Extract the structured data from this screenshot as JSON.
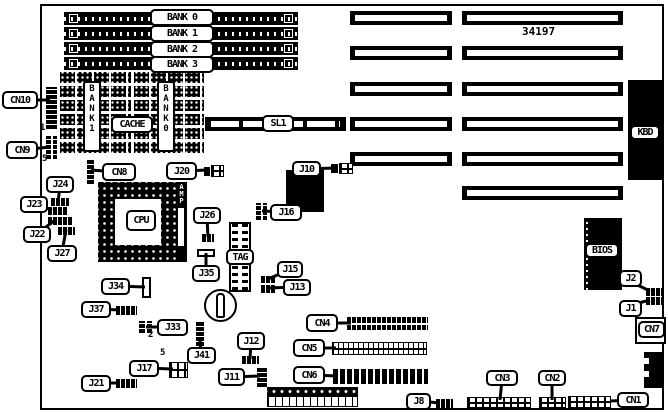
{
  "figure": {
    "part_number": "34197",
    "subject": "motherboard-layout-diagram"
  },
  "board": {
    "x": 40,
    "y": 4,
    "w": 624,
    "h": 406
  },
  "labels": [
    {
      "name": "label-cn10",
      "text": "CN10",
      "x": 2,
      "y": 91,
      "w": 36,
      "h": 18
    },
    {
      "name": "label-cn9",
      "text": "CN9",
      "x": 6,
      "y": 141,
      "w": 32,
      "h": 18
    },
    {
      "name": "label-j24",
      "text": "J24",
      "x": 46,
      "y": 176,
      "w": 28,
      "h": 17
    },
    {
      "name": "label-j23",
      "text": "J23",
      "x": 20,
      "y": 196,
      "w": 28,
      "h": 17
    },
    {
      "name": "label-j22",
      "text": "J22",
      "x": 23,
      "y": 226,
      "w": 28,
      "h": 17
    },
    {
      "name": "label-j27",
      "text": "J27",
      "x": 47,
      "y": 245,
      "w": 30,
      "h": 17
    },
    {
      "name": "label-cn8",
      "text": "CN8",
      "x": 102,
      "y": 163,
      "w": 34,
      "h": 18
    },
    {
      "name": "label-j20",
      "text": "J20",
      "x": 166,
      "y": 162,
      "w": 31,
      "h": 18
    },
    {
      "name": "label-j26",
      "text": "J26",
      "x": 193,
      "y": 207,
      "w": 28,
      "h": 17
    },
    {
      "name": "label-j35",
      "text": "J35",
      "x": 192,
      "y": 265,
      "w": 28,
      "h": 17
    },
    {
      "name": "label-j34",
      "text": "J34",
      "x": 101,
      "y": 278,
      "w": 29,
      "h": 17
    },
    {
      "name": "label-j37",
      "text": "J37",
      "x": 81,
      "y": 301,
      "w": 30,
      "h": 17
    },
    {
      "name": "label-j33",
      "text": "J33",
      "x": 157,
      "y": 319,
      "w": 31,
      "h": 17
    },
    {
      "name": "label-j41",
      "text": "J41",
      "x": 187,
      "y": 347,
      "w": 29,
      "h": 17
    },
    {
      "name": "label-j17",
      "text": "J17",
      "x": 129,
      "y": 360,
      "w": 30,
      "h": 17
    },
    {
      "name": "label-j21",
      "text": "J21",
      "x": 81,
      "y": 375,
      "w": 30,
      "h": 17
    },
    {
      "name": "label-j12",
      "text": "J12",
      "x": 237,
      "y": 332,
      "w": 28,
      "h": 18
    },
    {
      "name": "label-j11",
      "text": "J11",
      "x": 218,
      "y": 368,
      "w": 27,
      "h": 18
    },
    {
      "name": "label-j15",
      "text": "J15",
      "x": 277,
      "y": 261,
      "w": 26,
      "h": 17
    },
    {
      "name": "label-j13",
      "text": "J13",
      "x": 283,
      "y": 279,
      "w": 28,
      "h": 17
    },
    {
      "name": "label-j10",
      "text": "J10",
      "x": 292,
      "y": 161,
      "w": 29,
      "h": 16
    },
    {
      "name": "label-j16",
      "text": "J16",
      "x": 270,
      "y": 204,
      "w": 32,
      "h": 17
    },
    {
      "name": "label-cn4",
      "text": "CN4",
      "x": 306,
      "y": 314,
      "w": 32,
      "h": 18
    },
    {
      "name": "label-cn5",
      "text": "CN5",
      "x": 293,
      "y": 339,
      "w": 32,
      "h": 18
    },
    {
      "name": "label-cn6",
      "text": "CN6",
      "x": 293,
      "y": 366,
      "w": 32,
      "h": 18
    },
    {
      "name": "label-j8",
      "text": "J8",
      "x": 406,
      "y": 393,
      "w": 25,
      "h": 17
    },
    {
      "name": "label-cn3",
      "text": "CN3",
      "x": 486,
      "y": 370,
      "w": 32,
      "h": 16
    },
    {
      "name": "label-cn2",
      "text": "CN2",
      "x": 538,
      "y": 370,
      "w": 28,
      "h": 16
    },
    {
      "name": "label-cn1",
      "text": "CN1",
      "x": 617,
      "y": 392,
      "w": 32,
      "h": 16
    },
    {
      "name": "label-j2",
      "text": "J2",
      "x": 619,
      "y": 270,
      "w": 23,
      "h": 17
    },
    {
      "name": "label-j1",
      "text": "J1",
      "x": 619,
      "y": 300,
      "w": 23,
      "h": 17
    },
    {
      "name": "label-cn7",
      "text": "CN7",
      "x": 638,
      "y": 321,
      "w": 27,
      "h": 17
    }
  ],
  "chip_labels": [
    {
      "name": "label-bank0",
      "text": "BANK 0",
      "x": 150,
      "y": 9,
      "w": 64,
      "h": 17
    },
    {
      "name": "label-bank1",
      "text": "BANK 1",
      "x": 150,
      "y": 25,
      "w": 64,
      "h": 17
    },
    {
      "name": "label-bank2",
      "text": "BANK 2",
      "x": 150,
      "y": 41,
      "w": 64,
      "h": 17
    },
    {
      "name": "label-bank3",
      "text": "BANK 3",
      "x": 150,
      "y": 56,
      "w": 64,
      "h": 17
    },
    {
      "name": "label-sl1",
      "text": "SL1",
      "x": 262,
      "y": 115,
      "w": 32,
      "h": 17
    },
    {
      "name": "label-cache",
      "text": "CACHE",
      "x": 111,
      "y": 116,
      "w": 42,
      "h": 17
    },
    {
      "name": "label-cpu",
      "text": "CPU",
      "x": 126,
      "y": 210,
      "w": 30,
      "h": 21
    },
    {
      "name": "label-tag",
      "text": "TAG",
      "x": 226,
      "y": 249,
      "w": 28,
      "h": 16
    },
    {
      "name": "label-bios",
      "text": "BIOS",
      "x": 585,
      "y": 243,
      "w": 34,
      "h": 15
    },
    {
      "name": "label-kbd",
      "text": "KBD",
      "x": 630,
      "y": 125,
      "w": 30,
      "h": 15
    }
  ],
  "vertical_labels": [
    {
      "name": "label-sram-bank1",
      "text": "B\nA\nN\nK\n1",
      "x": 83,
      "y": 81,
      "w": 18,
      "h": 71
    },
    {
      "name": "label-sram-bank0",
      "text": "B\nA\nN\nK\n0",
      "x": 157,
      "y": 81,
      "w": 18,
      "h": 71
    }
  ],
  "texts": [
    {
      "name": "part-number",
      "text": "34197",
      "x": 522,
      "y": 25,
      "size": 11
    },
    {
      "name": "pin1-marker-cn10",
      "text": "1",
      "x": 40,
      "y": 123,
      "size": 9
    },
    {
      "name": "pin5-marker-cn9",
      "text": "5",
      "x": 42,
      "y": 154,
      "size": 9
    },
    {
      "name": "pin2-marker-j33",
      "text": "2",
      "x": 148,
      "y": 330,
      "size": 9
    },
    {
      "name": "pin5-marker-j17",
      "text": "5",
      "x": 160,
      "y": 348,
      "size": 9
    }
  ],
  "chips": [
    {
      "name": "kbd-connector",
      "cls": "chip",
      "x": 628,
      "y": 80,
      "w": 36,
      "h": 100
    },
    {
      "name": "bios-chip",
      "cls": "bios",
      "x": 584,
      "y": 218,
      "w": 38,
      "h": 72
    },
    {
      "name": "controller-chip",
      "cls": "chip",
      "x": 286,
      "y": 170,
      "w": 38,
      "h": 42
    },
    {
      "name": "amp-voltage-regulator",
      "cls": "amp",
      "x": 176,
      "y": 182,
      "w": 11,
      "h": 80,
      "text": "AMP"
    },
    {
      "name": "cpu-socket",
      "cls": "cpusocket",
      "x": 98,
      "y": 182,
      "w": 80,
      "h": 80
    },
    {
      "name": "tag-ram-chip",
      "cls": "tagchip",
      "x": 229,
      "y": 222,
      "w": 22,
      "h": 70
    },
    {
      "name": "cache-sram-array-bank1",
      "cls": "sram",
      "x": 60,
      "y": 70,
      "w": 71,
      "h": 83
    },
    {
      "name": "cache-sram-array-bank0",
      "cls": "sram",
      "x": 134,
      "y": 70,
      "w": 70,
      "h": 83
    },
    {
      "name": "sl1-slot",
      "cls": "sl1",
      "x": 205,
      "y": 117,
      "w": 141,
      "h": 14
    },
    {
      "name": "battery",
      "cls": "battery",
      "x": 204,
      "y": 289,
      "w": 33,
      "h": 33
    },
    {
      "name": "battery-capsule",
      "cls": "capsule",
      "x": 216,
      "y": 293,
      "w": 9,
      "h": 25
    },
    {
      "name": "power-connector-pins",
      "cls": "powertop",
      "x": 267,
      "y": 387,
      "w": 91,
      "h": 9
    },
    {
      "name": "power-connector-body",
      "cls": "powerbot",
      "x": 267,
      "y": 396,
      "w": 91,
      "h": 11
    },
    {
      "name": "edge-connector",
      "cls": "chip",
      "x": 644,
      "y": 352,
      "w": 20,
      "h": 36
    },
    {
      "name": "edge-connector-notch-a",
      "cls": "notch",
      "x": 644,
      "y": 358,
      "w": 5,
      "h": 6
    },
    {
      "name": "edge-connector-notch-b",
      "cls": "notch",
      "x": 644,
      "y": 371,
      "w": 5,
      "h": 6
    },
    {
      "name": "cn7-connector-body",
      "cls": "whitebox",
      "x": 635,
      "y": 317,
      "w": 31,
      "h": 27
    }
  ],
  "headers": [
    {
      "name": "cn10-header",
      "cls": "vstrip",
      "x": 46,
      "y": 87,
      "w": 11,
      "h": 42
    },
    {
      "name": "cn9-header",
      "cls": "grid2",
      "x": 46,
      "y": 136,
      "w": 11,
      "h": 23
    },
    {
      "name": "j24-jumper",
      "cls": "hstrip",
      "x": 51,
      "y": 198,
      "w": 18,
      "h": 8
    },
    {
      "name": "j23-jumper",
      "cls": "hstrip",
      "x": 48,
      "y": 207,
      "w": 20,
      "h": 8
    },
    {
      "name": "j22-jumper",
      "cls": "hstrip",
      "x": 48,
      "y": 217,
      "w": 25,
      "h": 8
    },
    {
      "name": "j27-jumper",
      "cls": "hstrip",
      "x": 58,
      "y": 227,
      "w": 17,
      "h": 8
    },
    {
      "name": "cn8-header",
      "cls": "vstrip",
      "x": 87,
      "y": 160,
      "w": 7,
      "h": 24
    },
    {
      "name": "j20-header-pin",
      "cls": "solidsm",
      "x": 204,
      "y": 167,
      "w": 6,
      "h": 9
    },
    {
      "name": "j20-header",
      "cls": "hbox",
      "x": 211,
      "y": 165,
      "w": 13,
      "h": 12
    },
    {
      "name": "j26-jumper",
      "cls": "hstrip",
      "x": 202,
      "y": 234,
      "w": 12,
      "h": 8
    },
    {
      "name": "j35-component",
      "cls": "whitebox",
      "x": 197,
      "y": 249,
      "w": 18,
      "h": 8
    },
    {
      "name": "j34-component",
      "cls": "whitebox",
      "x": 142,
      "y": 277,
      "w": 9,
      "h": 21
    },
    {
      "name": "j37-jumper",
      "cls": "hstrip",
      "x": 116,
      "y": 306,
      "w": 21,
      "h": 9
    },
    {
      "name": "j33-jumper",
      "cls": "grid2",
      "x": 139,
      "y": 321,
      "w": 13,
      "h": 12
    },
    {
      "name": "j41-header",
      "cls": "vstrip",
      "x": 196,
      "y": 321,
      "w": 8,
      "h": 25
    },
    {
      "name": "j17-header",
      "cls": "hbox",
      "x": 169,
      "y": 362,
      "w": 19,
      "h": 16
    },
    {
      "name": "j21-jumper",
      "cls": "hstrip",
      "x": 116,
      "y": 379,
      "w": 21,
      "h": 9
    },
    {
      "name": "j12-jumper",
      "cls": "hstrip",
      "x": 242,
      "y": 356,
      "w": 17,
      "h": 8
    },
    {
      "name": "j11-header",
      "cls": "vstrip",
      "x": 257,
      "y": 367,
      "w": 10,
      "h": 20
    },
    {
      "name": "j16-header",
      "cls": "grid2",
      "x": 256,
      "y": 203,
      "w": 11,
      "h": 17
    },
    {
      "name": "j15-jumper",
      "cls": "hstrip",
      "x": 261,
      "y": 276,
      "w": 14,
      "h": 7
    },
    {
      "name": "j13-jumper",
      "cls": "hstrip",
      "x": 261,
      "y": 285,
      "w": 14,
      "h": 8
    },
    {
      "name": "j10-header-pin",
      "cls": "solidsm",
      "x": 331,
      "y": 164,
      "w": 7,
      "h": 9
    },
    {
      "name": "j10-header",
      "cls": "hbox",
      "x": 339,
      "y": 163,
      "w": 14,
      "h": 11
    },
    {
      "name": "cn4-header",
      "cls": "cn4",
      "x": 347,
      "y": 317,
      "w": 81,
      "h": 13
    },
    {
      "name": "cn5-header",
      "cls": "hboxdense",
      "x": 332,
      "y": 342,
      "w": 95,
      "h": 13
    },
    {
      "name": "cn6-header",
      "cls": "cn6",
      "x": 333,
      "y": 369,
      "w": 95,
      "h": 15
    },
    {
      "name": "j8-header",
      "cls": "hstrip",
      "x": 436,
      "y": 399,
      "w": 17,
      "h": 9
    },
    {
      "name": "cn3-header",
      "cls": "hbox",
      "x": 467,
      "y": 397,
      "w": 64,
      "h": 11
    },
    {
      "name": "cn2-header",
      "cls": "hbox",
      "x": 539,
      "y": 397,
      "w": 27,
      "h": 11
    },
    {
      "name": "cn1-header",
      "cls": "hbox",
      "x": 568,
      "y": 396,
      "w": 43,
      "h": 12
    },
    {
      "name": "j2-jumper",
      "cls": "hstrip",
      "x": 646,
      "y": 288,
      "w": 17,
      "h": 8
    },
    {
      "name": "j1-jumper",
      "cls": "hstrip",
      "x": 646,
      "y": 297,
      "w": 17,
      "h": 8
    }
  ],
  "slots": [
    {
      "name": "isa-slot-l1",
      "x": 350,
      "y": 11,
      "w": 102,
      "h": 14
    },
    {
      "name": "isa-slot-l2",
      "x": 350,
      "y": 46,
      "w": 102,
      "h": 14
    },
    {
      "name": "isa-slot-l3",
      "x": 350,
      "y": 82,
      "w": 102,
      "h": 14
    },
    {
      "name": "isa-slot-l4",
      "x": 350,
      "y": 117,
      "w": 102,
      "h": 14
    },
    {
      "name": "isa-slot-l5",
      "x": 350,
      "y": 152,
      "w": 102,
      "h": 14
    },
    {
      "name": "isa-slot-r1",
      "x": 462,
      "y": 11,
      "w": 161,
      "h": 14
    },
    {
      "name": "isa-slot-r2",
      "x": 462,
      "y": 46,
      "w": 161,
      "h": 14
    },
    {
      "name": "isa-slot-r3",
      "x": 462,
      "y": 82,
      "w": 161,
      "h": 14
    },
    {
      "name": "isa-slot-r4",
      "x": 462,
      "y": 117,
      "w": 161,
      "h": 14
    },
    {
      "name": "isa-slot-r5",
      "x": 462,
      "y": 152,
      "w": 161,
      "h": 14
    },
    {
      "name": "isa-slot-r6",
      "x": 462,
      "y": 186,
      "w": 161,
      "h": 14
    }
  ],
  "simms": [
    {
      "name": "simm-socket-bank0",
      "x": 64,
      "y": 12,
      "w": 234,
      "h": 13
    },
    {
      "name": "simm-socket-bank1",
      "x": 64,
      "y": 27,
      "w": 234,
      "h": 13
    },
    {
      "name": "simm-socket-bank2",
      "x": 64,
      "y": 42,
      "w": 234,
      "h": 13
    },
    {
      "name": "simm-socket-bank3",
      "x": 64,
      "y": 57,
      "w": 234,
      "h": 13
    }
  ],
  "leaders": [
    [
      20,
      100,
      50,
      100
    ],
    [
      21,
      150,
      50,
      147
    ],
    [
      60,
      186,
      58,
      202
    ],
    [
      34,
      204,
      52,
      210
    ],
    [
      37,
      234,
      55,
      220
    ],
    [
      62,
      252,
      66,
      230
    ],
    [
      117,
      172,
      91,
      170
    ],
    [
      182,
      171,
      208,
      170
    ],
    [
      207,
      217,
      208,
      237
    ],
    [
      206,
      272,
      206,
      253
    ],
    [
      116,
      286,
      145,
      287
    ],
    [
      97,
      309,
      120,
      310
    ],
    [
      171,
      327,
      146,
      327
    ],
    [
      201,
      354,
      200,
      340
    ],
    [
      145,
      368,
      173,
      369
    ],
    [
      97,
      383,
      120,
      383
    ],
    [
      251,
      342,
      250,
      359
    ],
    [
      232,
      377,
      260,
      376
    ],
    [
      289,
      270,
      268,
      279
    ],
    [
      296,
      287,
      268,
      288
    ],
    [
      307,
      169,
      334,
      168
    ],
    [
      285,
      212,
      262,
      211
    ],
    [
      323,
      323,
      351,
      323
    ],
    [
      310,
      348,
      336,
      348
    ],
    [
      310,
      375,
      338,
      376
    ],
    [
      419,
      401,
      440,
      403
    ],
    [
      502,
      379,
      500,
      400
    ],
    [
      552,
      378,
      552,
      400
    ],
    [
      632,
      400,
      610,
      401
    ],
    [
      631,
      282,
      650,
      291
    ],
    [
      631,
      305,
      650,
      300
    ]
  ]
}
